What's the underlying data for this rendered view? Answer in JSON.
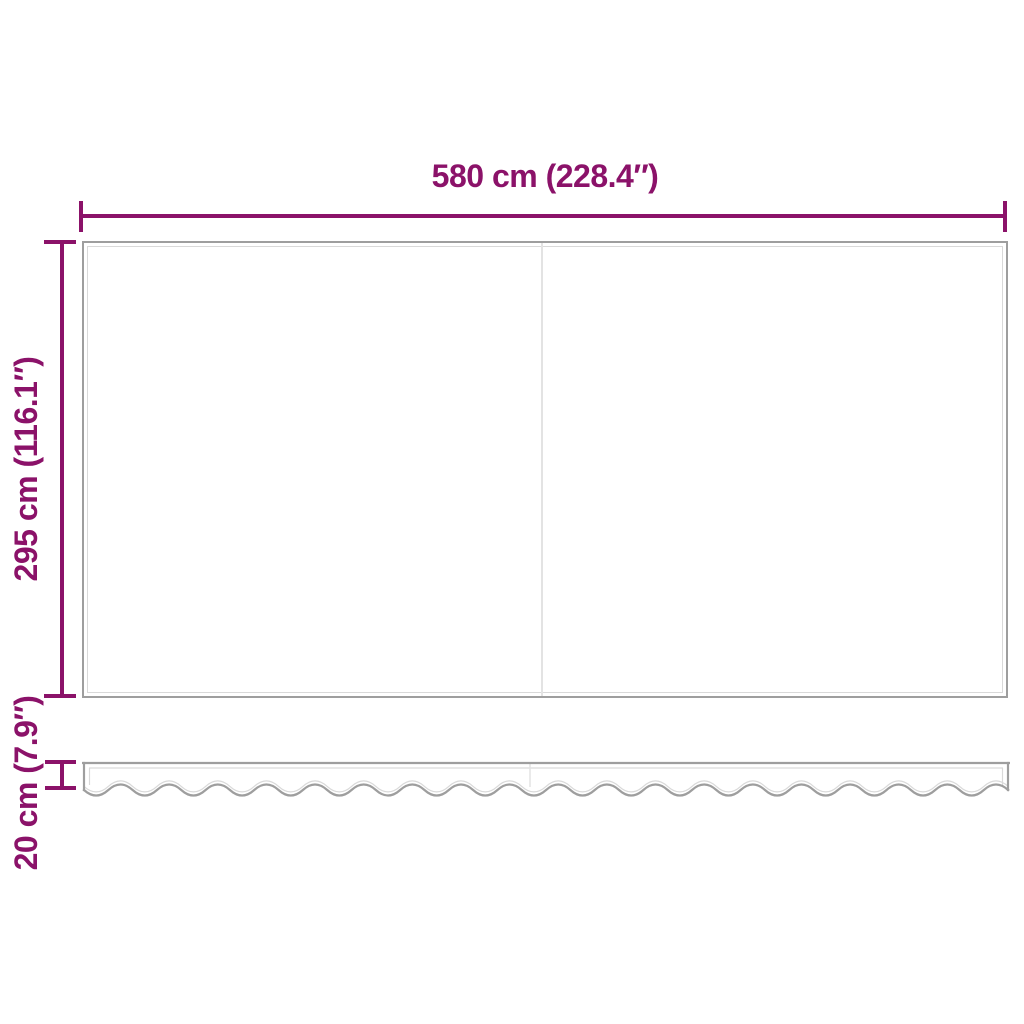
{
  "dimensions": {
    "width": {
      "value_cm": 580,
      "value_in": 228.4,
      "label": "580 cm (228.4″)"
    },
    "height": {
      "value_cm": 295,
      "value_in": 116.1,
      "label": "295 cm (116.1″)"
    },
    "valance": {
      "value_cm": 20,
      "value_in": 7.9,
      "label": "20 cm (7.9″)"
    }
  },
  "colors": {
    "dimension": "#8B1269",
    "outline": "#9E9E9E",
    "outline_light": "#D9D9D9",
    "seam": "#E3E3E3",
    "background": "#FFFFFF"
  }
}
